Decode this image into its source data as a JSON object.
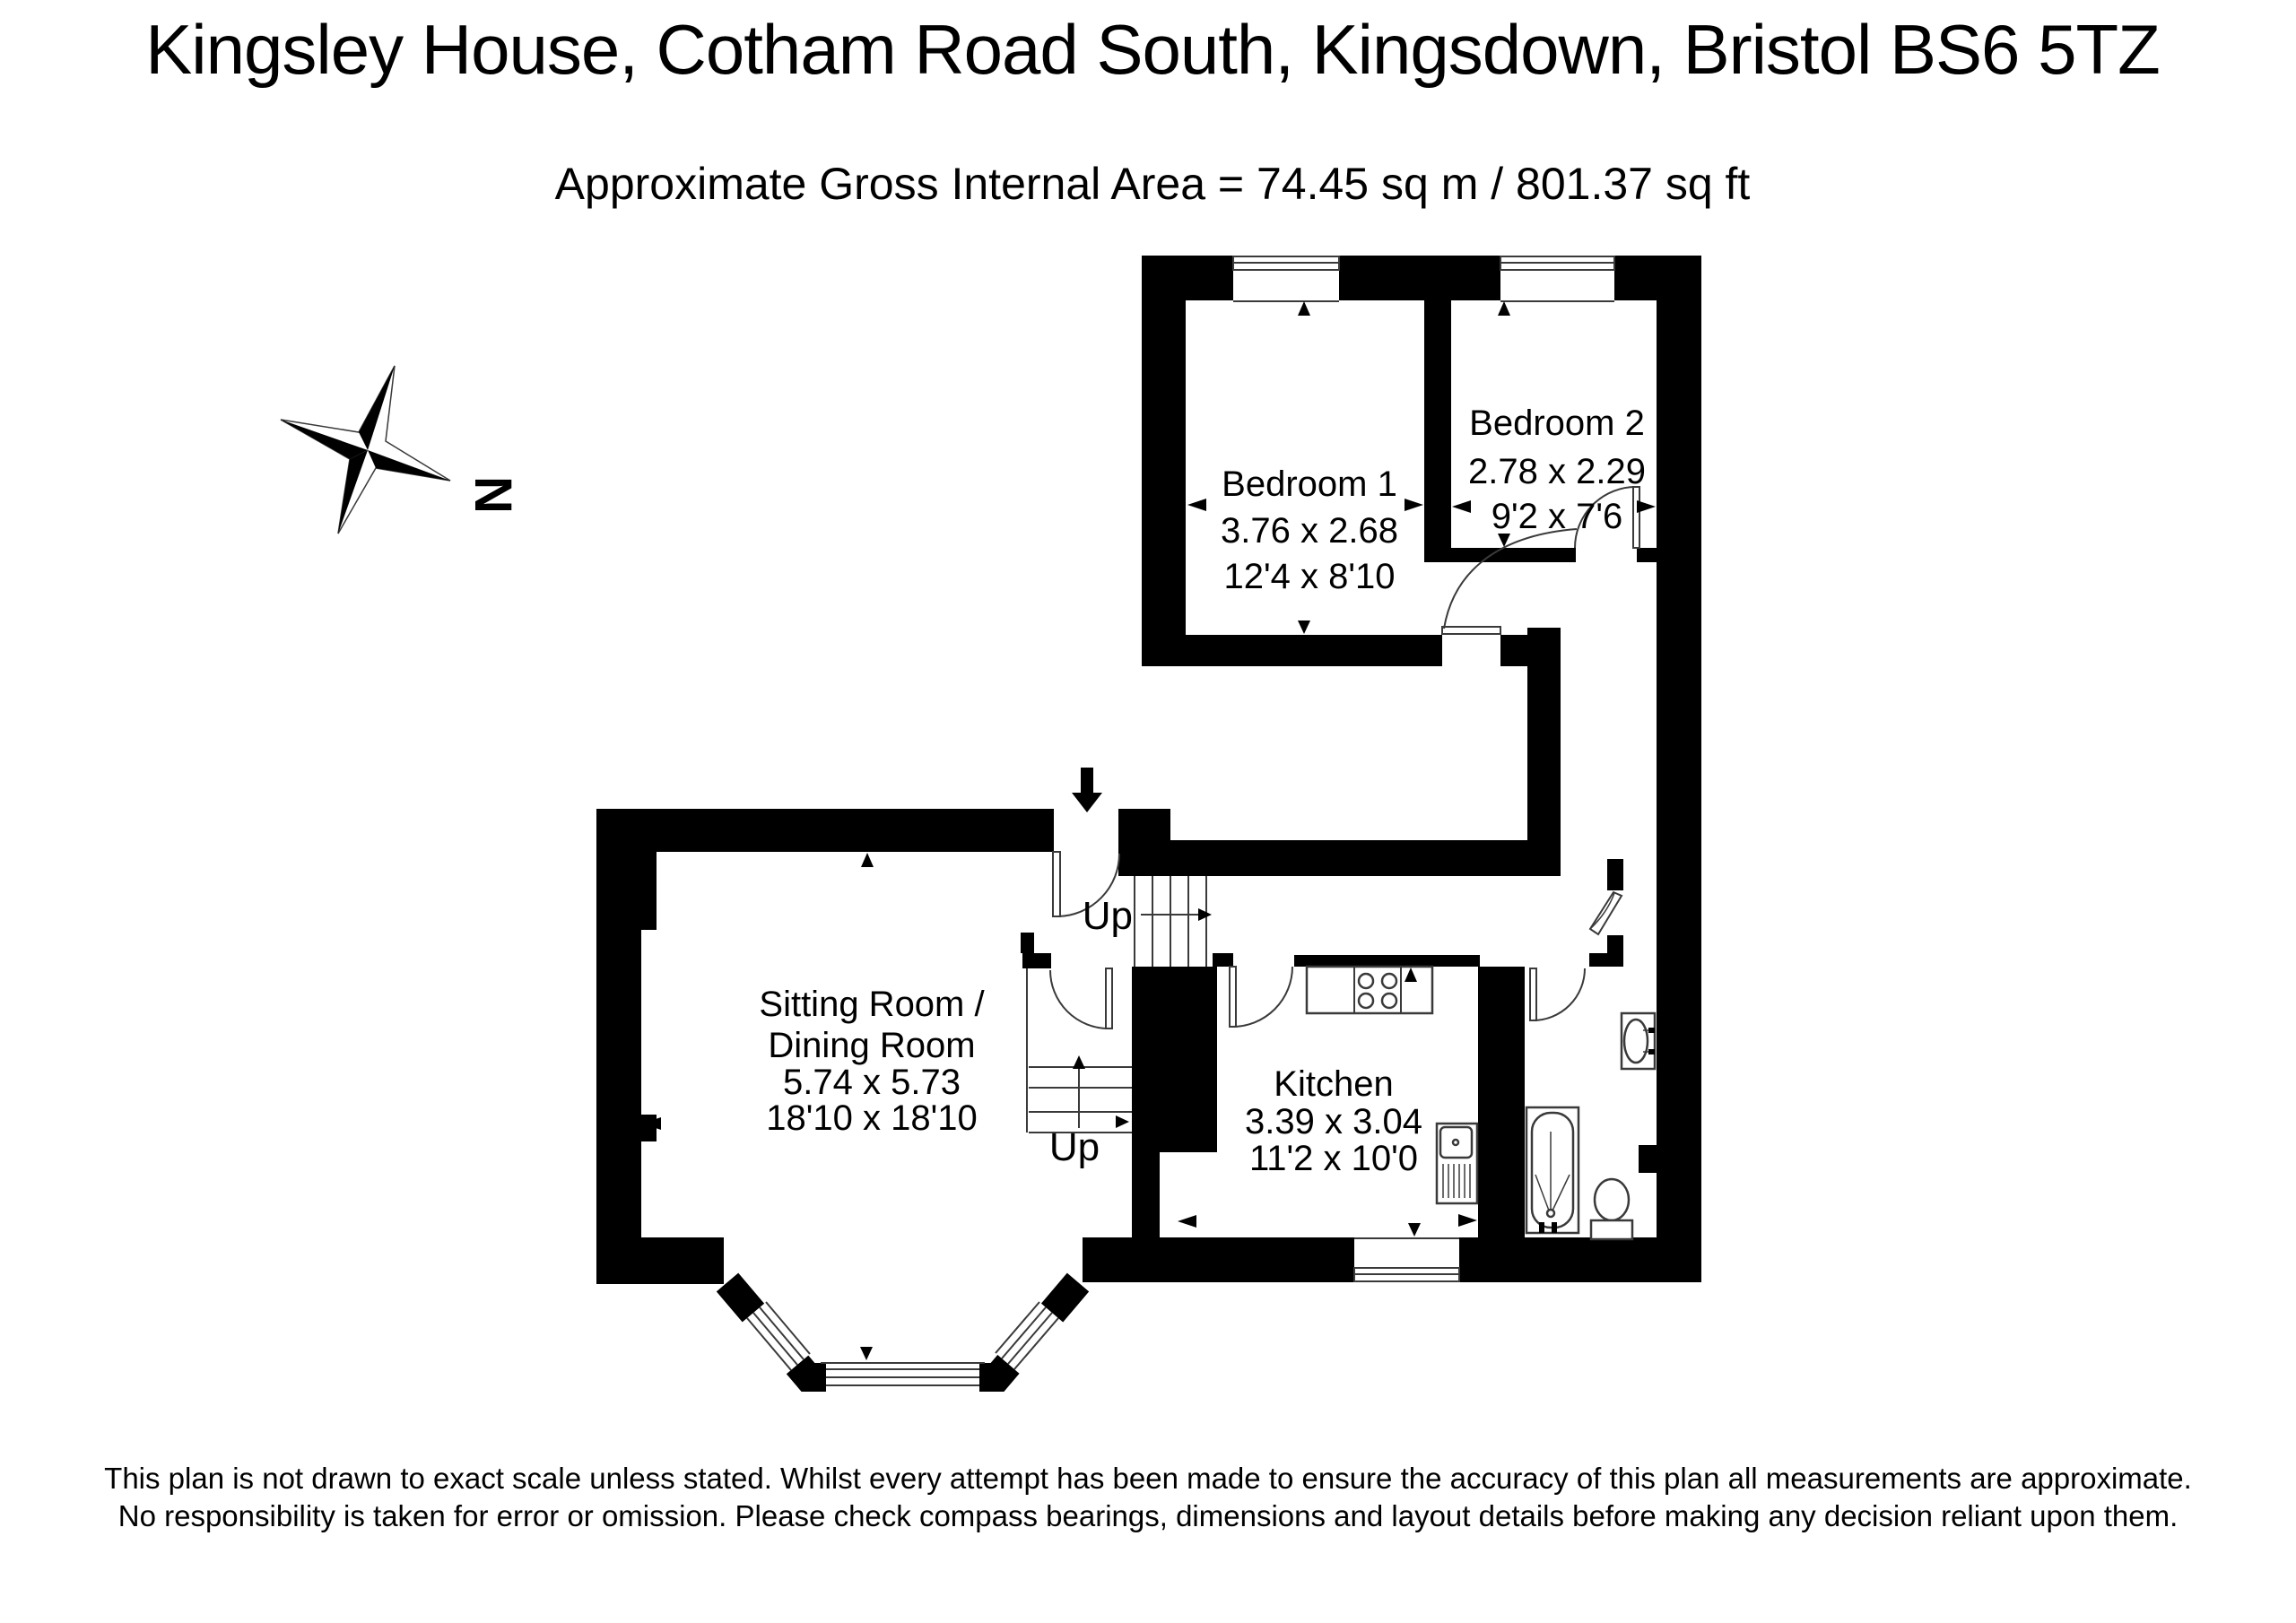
{
  "header": {
    "title": "Kingsley House, Cotham Road South, Kingsdown, Bristol  BS6 5TZ",
    "subtitle": "Approximate Gross Internal Area = 74.45 sq m / 801.37 sq ft"
  },
  "compass": {
    "north_label": "N"
  },
  "rooms": {
    "bedroom1": {
      "name": "Bedroom 1",
      "size_metric": "3.76 x 2.68",
      "size_imperial": "12'4 x 8'10"
    },
    "bedroom2": {
      "name": "Bedroom 2",
      "size_metric": "2.78 x 2.29",
      "size_imperial": "9'2 x 7'6"
    },
    "sitting_dining": {
      "name_line1": "Sitting Room /",
      "name_line2": "Dining Room",
      "size_metric": "5.74 x 5.73",
      "size_imperial": "18'10 x 18'10"
    },
    "kitchen": {
      "name": "Kitchen",
      "size_metric": "3.39 x 3.04",
      "size_imperial": "11'2 x 10'0"
    }
  },
  "stairs": {
    "upper_label": "Up",
    "lower_label": "Up"
  },
  "footer": {
    "line1": "This plan is not drawn to exact scale unless stated.  Whilst every attempt has been made to ensure the accuracy of this plan all measurements are approximate.",
    "line2": "No responsibility is taken for error or omission.  Please check compass bearings, dimensions and layout details before making any decision reliant upon them."
  },
  "colors": {
    "wall": "#000000",
    "background": "#ffffff",
    "line": "#3a3a3a"
  }
}
